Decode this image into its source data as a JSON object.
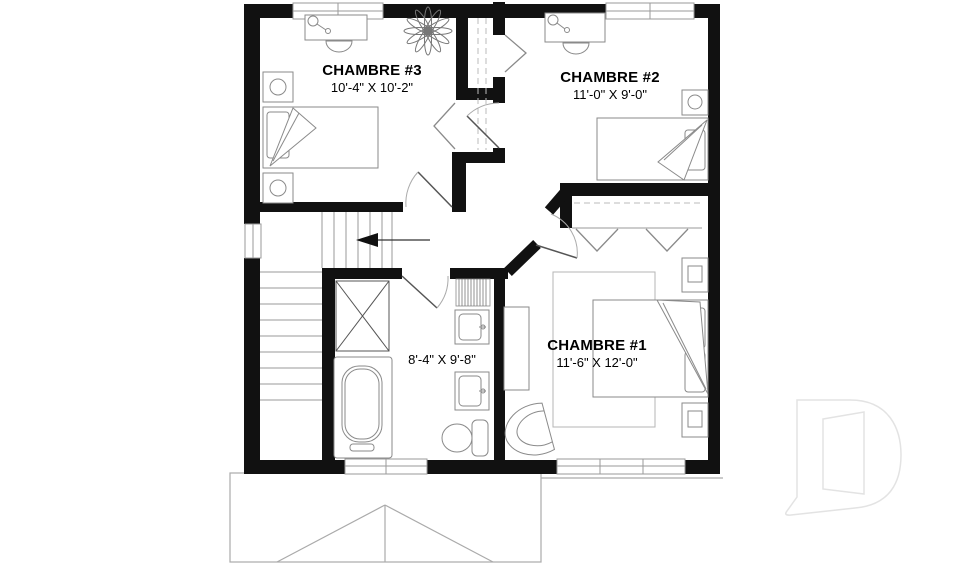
{
  "plan": {
    "type": "floor-plan",
    "language": "French",
    "watermark_icon": "drummond-d-logo"
  },
  "rooms": [
    {
      "id": "chambre-3",
      "name": "CHAMBRE #3",
      "dimensions": "10'-4\" X 10'-2\""
    },
    {
      "id": "chambre-2",
      "name": "CHAMBRE #2",
      "dimensions": "11'-0\" X 9'-0\""
    },
    {
      "id": "chambre-1",
      "name": "CHAMBRE #1",
      "dimensions": "11'-6\" X 12'-0\""
    },
    {
      "id": "bathroom",
      "name": "",
      "dimensions": "8'-4\" X 9'-8\""
    }
  ],
  "stairs": {
    "arrow_direction": "left"
  },
  "fixtures": [
    "desk-with-lamp",
    "desk-chair",
    "houseplant",
    "nightstand-with-lamp",
    "single-bed",
    "double-bed",
    "pillows",
    "folded-blanket",
    "area-rug",
    "dresser",
    "fan-back-chair",
    "wardrobe-closet",
    "bifold-closet-doors",
    "linen-closet",
    "storage-closet-x",
    "bathtub",
    "vanity-sink",
    "toilet",
    "staircase",
    "windows",
    "hinged-doors",
    "lower-roof-outline"
  ],
  "colors": {
    "background": "#ffffff",
    "walls": "#111111",
    "furniture_lines": "#8a8a8a",
    "stair_lines": "#999999",
    "roof_lines": "#aaaaaa",
    "text": "#000000",
    "watermark": "#e3e3e3"
  }
}
